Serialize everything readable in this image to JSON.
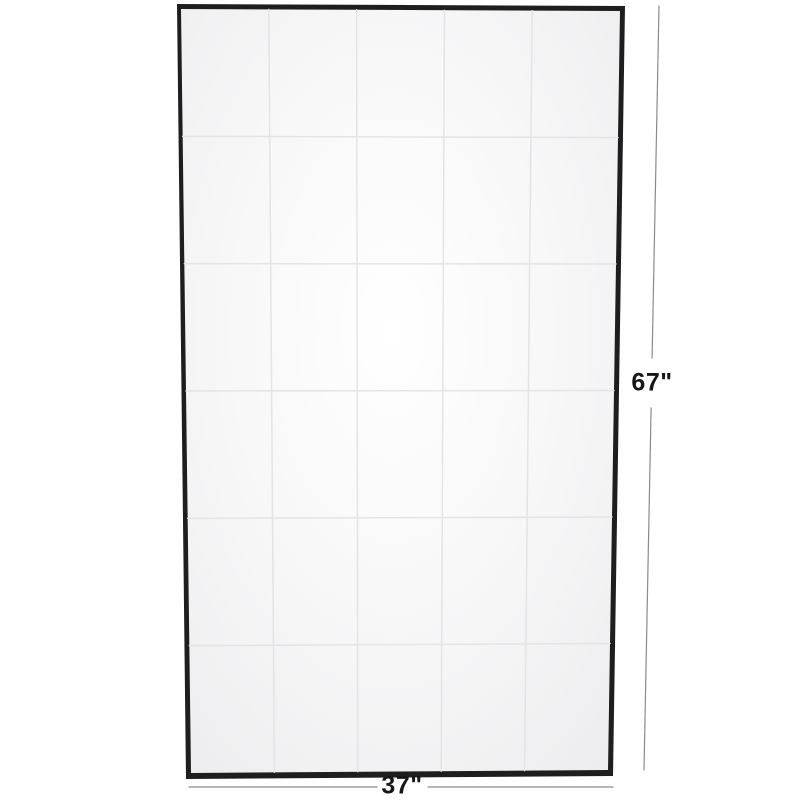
{
  "product": {
    "name": "framed-wall-mirror",
    "style": "thin-frame windowpane mirror, front view"
  },
  "dimensions": {
    "height_label": "67\"",
    "width_label": "37\""
  },
  "grid": {
    "rows": 6,
    "columns": 5
  },
  "colors": {
    "background": "#ffffff",
    "frame": "#1e1e1e",
    "surface_center": "#ffffff",
    "surface_mid": "#f7f7f8",
    "surface_edge": "#ececee",
    "grid_line": "#e4e4e6",
    "dimension_line": "#8a8a8a",
    "label_text": "#161616"
  }
}
